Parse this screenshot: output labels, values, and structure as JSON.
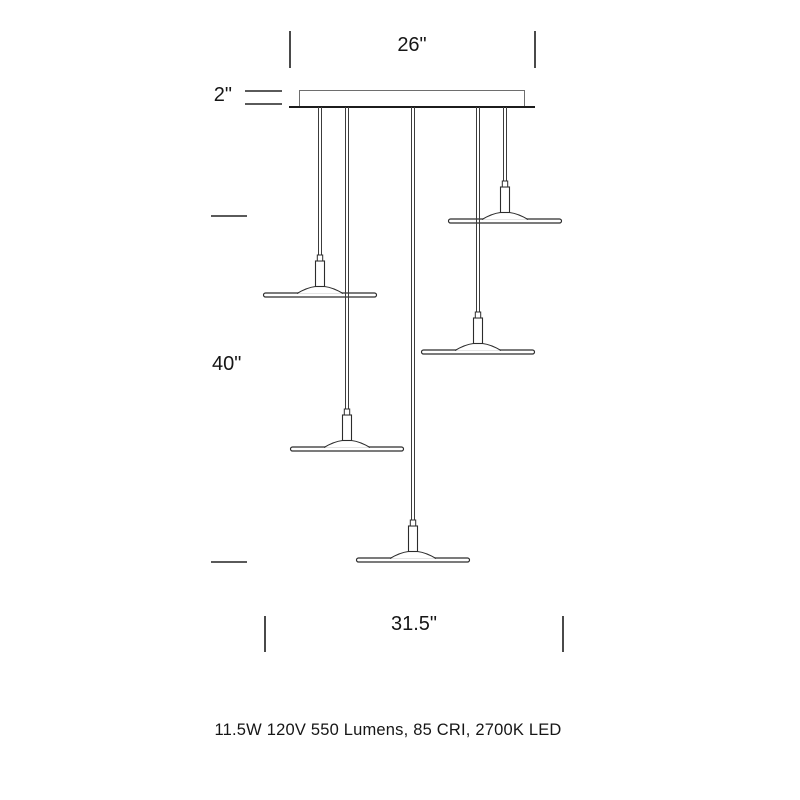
{
  "drawing": {
    "kind": "multi-pendant light fixture dimension diagram",
    "pendant_count": 5,
    "dimensions": {
      "canopy_width": "26\"",
      "canopy_height": "2\"",
      "drop_height": "40\"",
      "spread_width": "31.5\""
    },
    "spec_text": "11.5W 120V 550 Lumens, 85 CRI, 2700K LED",
    "colors": {
      "line_dark": "#1c1c1c",
      "line_medium": "#3c3c3c",
      "line_light": "#6e6e6e",
      "tick": "#4a4a4a",
      "text": "#161616",
      "background": "#ffffff"
    }
  }
}
